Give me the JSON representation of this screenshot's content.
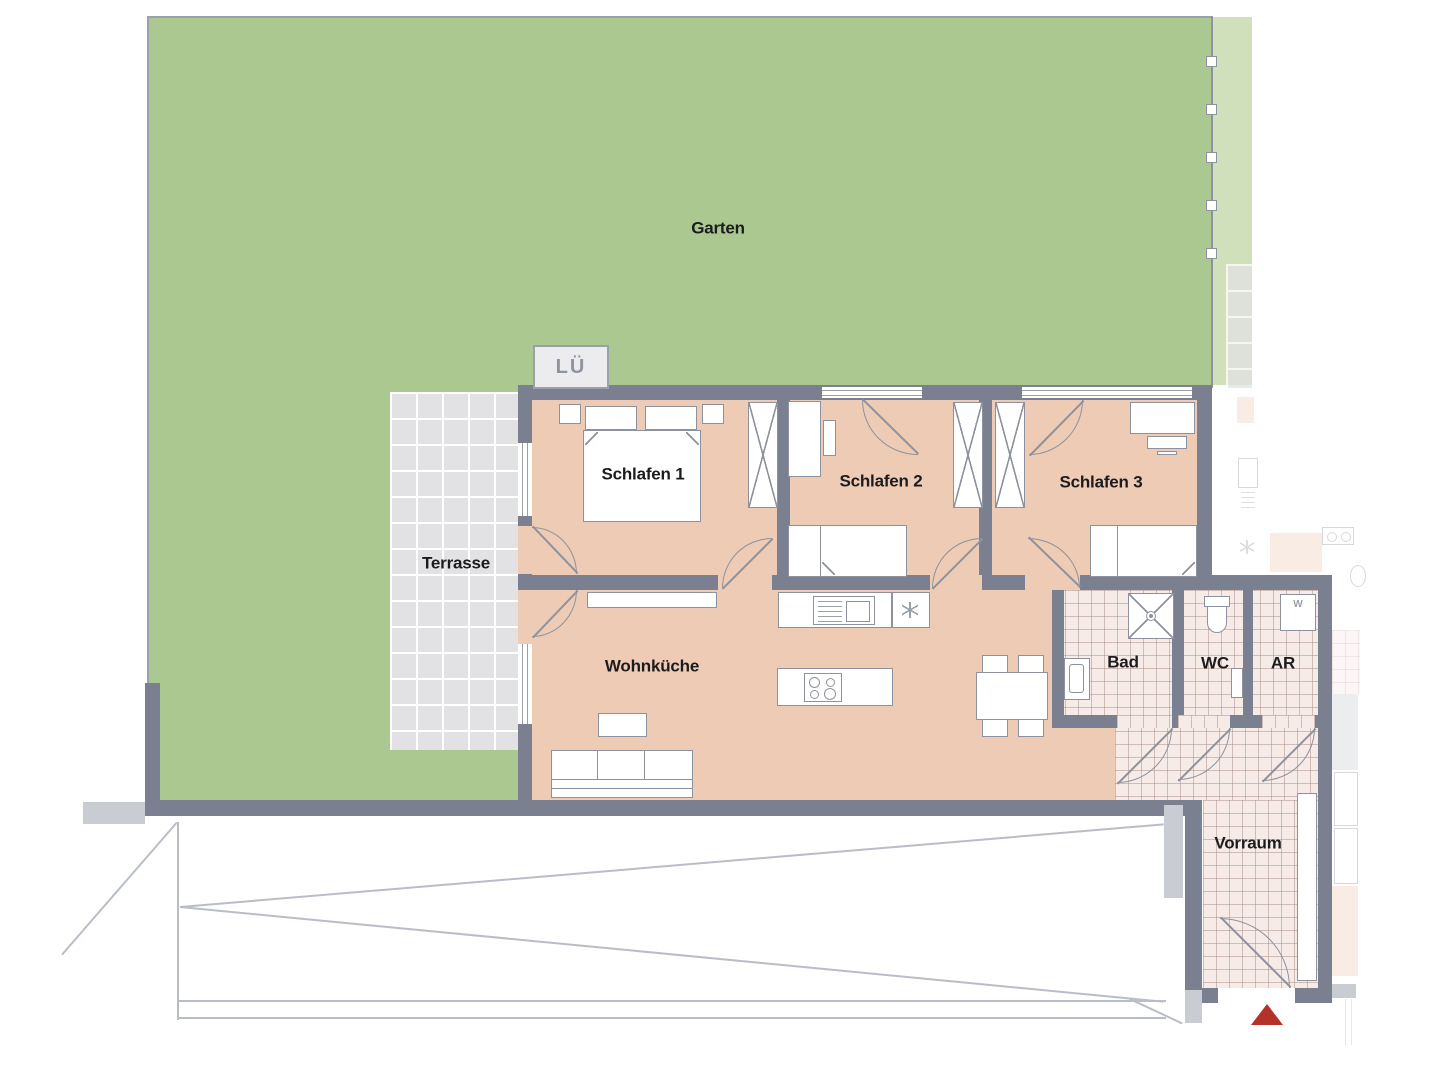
{
  "plan": {
    "title": "Wohnungsgrundriss",
    "rooms": {
      "garden": "Garten",
      "terrace": "Terrasse",
      "bedroom_1": "Schlafen 1",
      "bedroom_2": "Schlafen 2",
      "bedroom_3": "Schlafen 3",
      "living_kitchen": "Wohnküche",
      "bathroom": "Bad",
      "toilet": "WC",
      "storage_room": "AR",
      "entrance_hall": "Vorraum"
    },
    "annotations": {
      "ventilation": "LÜ",
      "washing_machine": "W"
    },
    "colors": {
      "garden": "#aac88f",
      "neighbor_garden": "#cfe0ba",
      "floor": "#edcbb4",
      "wall": "#7b8090",
      "wall_light": "#c9ccd2",
      "tile_floor": "#f7ebe7",
      "terrace": "#e2e2e5",
      "furniture_outline": "#8d929e",
      "entrance_marker": "#b5322a"
    }
  }
}
